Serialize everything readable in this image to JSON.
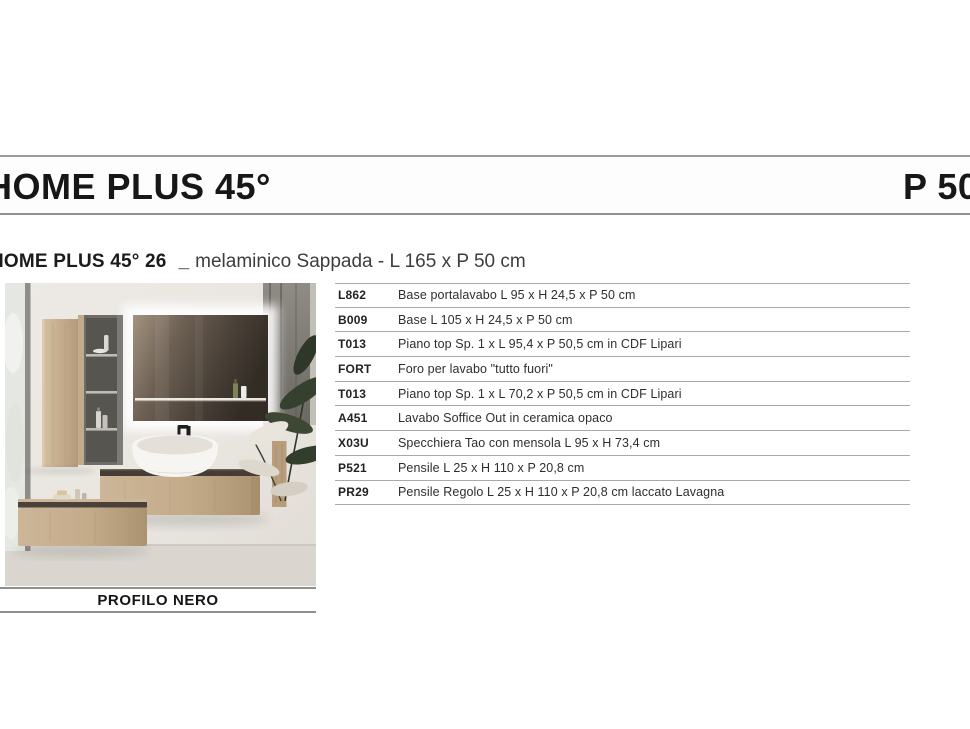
{
  "header": {
    "title": "HOME PLUS 45°",
    "right_title": "P 50"
  },
  "subtitle": {
    "model": "HOME PLUS 45° 26",
    "separator": "_",
    "description": "melaminico Sappada - L 165 x P 50 cm"
  },
  "photo": {
    "caption": "PROFILO NERO"
  },
  "table": {
    "rows": [
      {
        "code": "L862",
        "description": "Base portalavabo L 95 x H 24,5 x P 50 cm"
      },
      {
        "code": "B009",
        "description": "Base L 105 x H 24,5 x P 50 cm"
      },
      {
        "code": "T013",
        "description": "Piano top Sp. 1 x L 95,4 x P 50,5 cm in CDF Lipari"
      },
      {
        "code": "FORT",
        "description": "Foro per lavabo \"tutto fuori\""
      },
      {
        "code": "T013",
        "description": "Piano top Sp. 1 x L 70,2 x P 50,5 cm in CDF Lipari"
      },
      {
        "code": "A451",
        "description": "Lavabo Soffice Out in ceramica opaco"
      },
      {
        "code": "X03U",
        "description": "Specchiera Tao con mensola L 95 x H 73,4 cm"
      },
      {
        "code": "P521",
        "description": "Pensile L 25 x H 110 x P 20,8 cm"
      },
      {
        "code": "PR29",
        "description": "Pensile Regolo L 25 x H 110 x P 20,8 cm laccato Lavagna"
      }
    ]
  },
  "colors": {
    "rule_gray": "#9a9a9a",
    "text_dark": "#1b1b1b",
    "wood": "#c8b094",
    "dark_top": "#453d35"
  }
}
